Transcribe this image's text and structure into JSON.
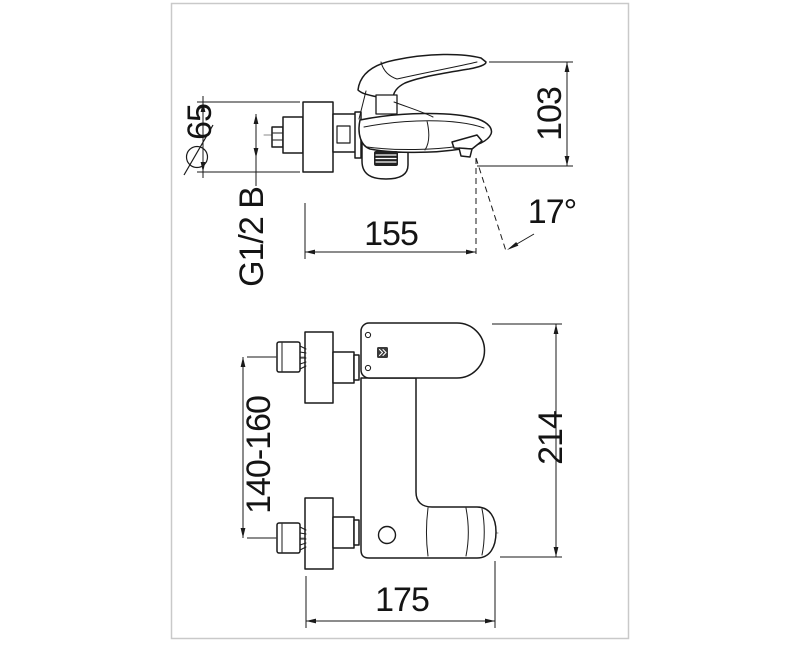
{
  "page": {
    "background": "#ffffff",
    "colors": {
      "line": "#1a1a1a",
      "frame": "#c9c9c9",
      "knob_fill": "#222222",
      "logo_fill": "#3a3a3a"
    }
  },
  "icons": {
    "diameter_symbol": "circle-with-slash ⌀",
    "brand_logo_mark": "» chevrons in dark square"
  },
  "drawing": {
    "type": "technical-dimension-drawing",
    "subject": "wall-mounted single-lever bath mixer faucet, two orthographic views",
    "views": {
      "side_view": {
        "dimensions": {
          "escutcheon_diameter": "65",
          "connection_thread": "G1/2 B",
          "spout_reach": "155",
          "body_height": "103",
          "spout_angle": "17°"
        }
      },
      "front_view": {
        "dimensions": {
          "connection_spacing_range": "140-160",
          "overall_height": "214",
          "overall_reach": "175"
        }
      }
    }
  }
}
